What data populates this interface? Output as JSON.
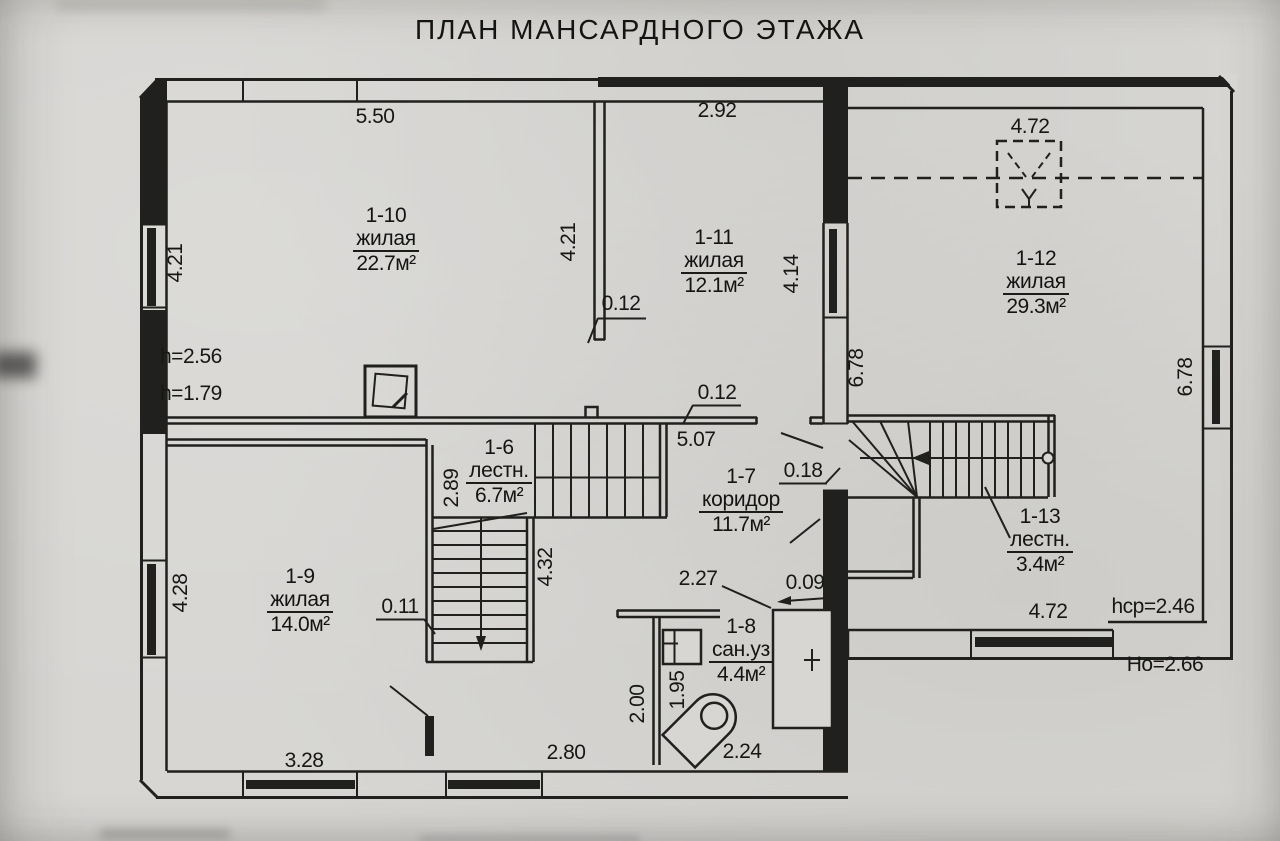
{
  "title": "ПЛАН МАНСАРДНОГО ЭТАЖА",
  "rooms": [
    {
      "number": "1-10",
      "type": "жилая",
      "area": "22.7м²"
    },
    {
      "number": "1-11",
      "type": "жилая",
      "area": "12.1м²"
    },
    {
      "number": "1-12",
      "type": "жилая",
      "area": "29.3м²"
    },
    {
      "number": "1-9",
      "type": "жилая",
      "area": "14.0м²"
    },
    {
      "number": "1-6",
      "type": "лестн.",
      "area": "6.7м²"
    },
    {
      "number": "1-7",
      "type": "коридор",
      "area": "11.7м²"
    },
    {
      "number": "1-8",
      "type": "сан.уз",
      "area": "4.4м²"
    },
    {
      "number": "1-13",
      "type": "лестн.",
      "area": "3.4м²"
    }
  ],
  "dims": {
    "top_1_10": "5.50",
    "top_1_11": "2.92",
    "top_right": "4.72",
    "left_upper": "4.21",
    "partition_1_10": "4.21",
    "right_1_11": "4.14",
    "right_wing_left": "6.78",
    "right_wing_right": "6.78",
    "partition_thickness": "0.12",
    "wall_thickness_mid": "0.12",
    "corridor_length": "5.07",
    "wall_thickness_018": "0.18",
    "stair_1_6_width": "2.89",
    "stair_1_6_length": "4.32",
    "stair_wall_thickness": "0.11",
    "left_lower": "4.28",
    "bath_width": "2.27",
    "bath_wall_thickness": "0.09",
    "bath_depth": "2.00",
    "sink_side": "1.95",
    "bath_bottom": "2.24",
    "bottom_mid": "2.80",
    "bottom_left": "3.28",
    "bottom_right_wing": "4.72"
  },
  "heights": {
    "h_upper": "h=2.56",
    "h_lower": "h=1.79",
    "h_avg": "hср=2.46",
    "h_o": "Но=2.66"
  }
}
